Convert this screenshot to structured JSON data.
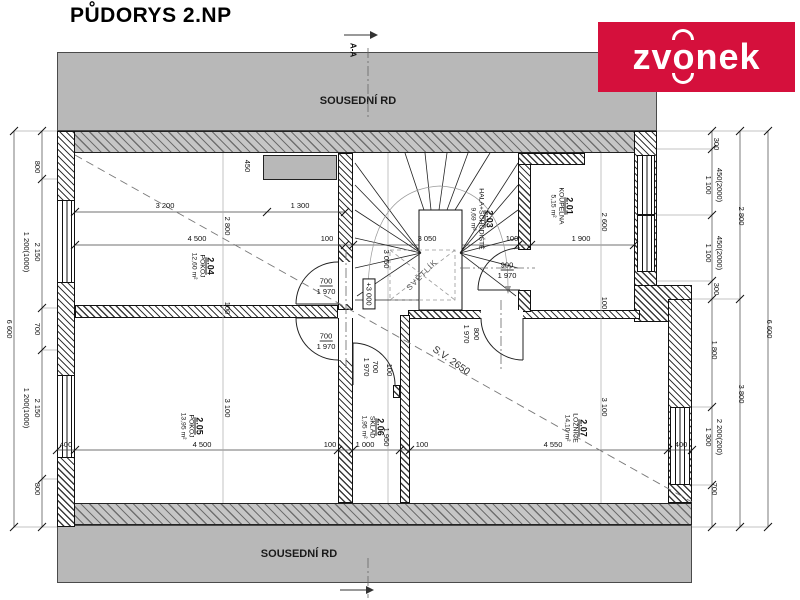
{
  "title": "PŮDORYS 2.NP",
  "logo": {
    "part1": "zv",
    "part2": "o",
    "part3": "nek",
    "bg_color": "#d5103c",
    "text_color": "#ffffff"
  },
  "neighbor_top": "SOUSEDNÍ RD",
  "neighbor_bottom": "SOUSEDNÍ RD",
  "section_label": "A-A",
  "level_mark": "+3 000",
  "clear_height_note": "S.V. 2650",
  "skylight_label": "SVĚTLÍK",
  "colors": {
    "neighbor_band": "#b8b8b8",
    "line": "#111111"
  },
  "rooms": [
    {
      "id": "2.01",
      "name": "KOUPELNA",
      "area": "5,15 m²"
    },
    {
      "id": "2.03",
      "name": "HALA+SCHODIŠTĚ",
      "area": "9,69 m²"
    },
    {
      "id": "2.04",
      "name": "POKOJ",
      "area": "12,60 m²"
    },
    {
      "id": "2.05",
      "name": "POKOJ",
      "area": "13,95 m²"
    },
    {
      "id": "2.06",
      "name": "SKLAD",
      "area": "1,95 m²"
    },
    {
      "id": "2.07",
      "name": "LOŽNICE",
      "area": "14,10 m²"
    }
  ],
  "dims": [
    {
      "t": "3 200"
    },
    {
      "t": "1 300"
    },
    {
      "t": "4 500"
    },
    {
      "t": "100"
    },
    {
      "t": "3 050"
    },
    {
      "t": "100"
    },
    {
      "t": "1 900"
    },
    {
      "t": "2 800"
    },
    {
      "t": "100"
    },
    {
      "t": "3 100"
    },
    {
      "t": "2 600"
    },
    {
      "t": "100"
    },
    {
      "t": "3 100"
    },
    {
      "t": "450"
    },
    {
      "t": "3 050"
    },
    {
      "t": "1 950"
    },
    {
      "t": "400"
    },
    {
      "t": "4 500"
    },
    {
      "t": "100"
    },
    {
      "t": "1 000"
    },
    {
      "t": "100"
    },
    {
      "t": "4 550"
    },
    {
      "t": "400"
    },
    {
      "t": "700"
    },
    {
      "t": "1 970"
    },
    {
      "t": "700"
    },
    {
      "t": "1 970"
    },
    {
      "t": "1 970"
    },
    {
      "t": "700"
    },
    {
      "t": "100"
    },
    {
      "t": "900"
    },
    {
      "t": "1 970"
    },
    {
      "t": "1 970"
    },
    {
      "t": "800"
    },
    {
      "t": "800"
    },
    {
      "t": "2 150"
    },
    {
      "t": "1 200(1000)"
    },
    {
      "t": "700"
    },
    {
      "t": "2 150"
    },
    {
      "t": "1 200(1000)"
    },
    {
      "t": "800"
    },
    {
      "t": "6 600"
    },
    {
      "t": "300"
    },
    {
      "t": "1 100"
    },
    {
      "t": "450(2000)"
    },
    {
      "t": "1 100"
    },
    {
      "t": "450(2000)"
    },
    {
      "t": "300"
    },
    {
      "t": "1 800"
    },
    {
      "t": "1 300"
    },
    {
      "t": "2 200(200)"
    },
    {
      "t": "700"
    },
    {
      "t": "2 800"
    },
    {
      "t": "3 800"
    },
    {
      "t": "6 600"
    }
  ]
}
